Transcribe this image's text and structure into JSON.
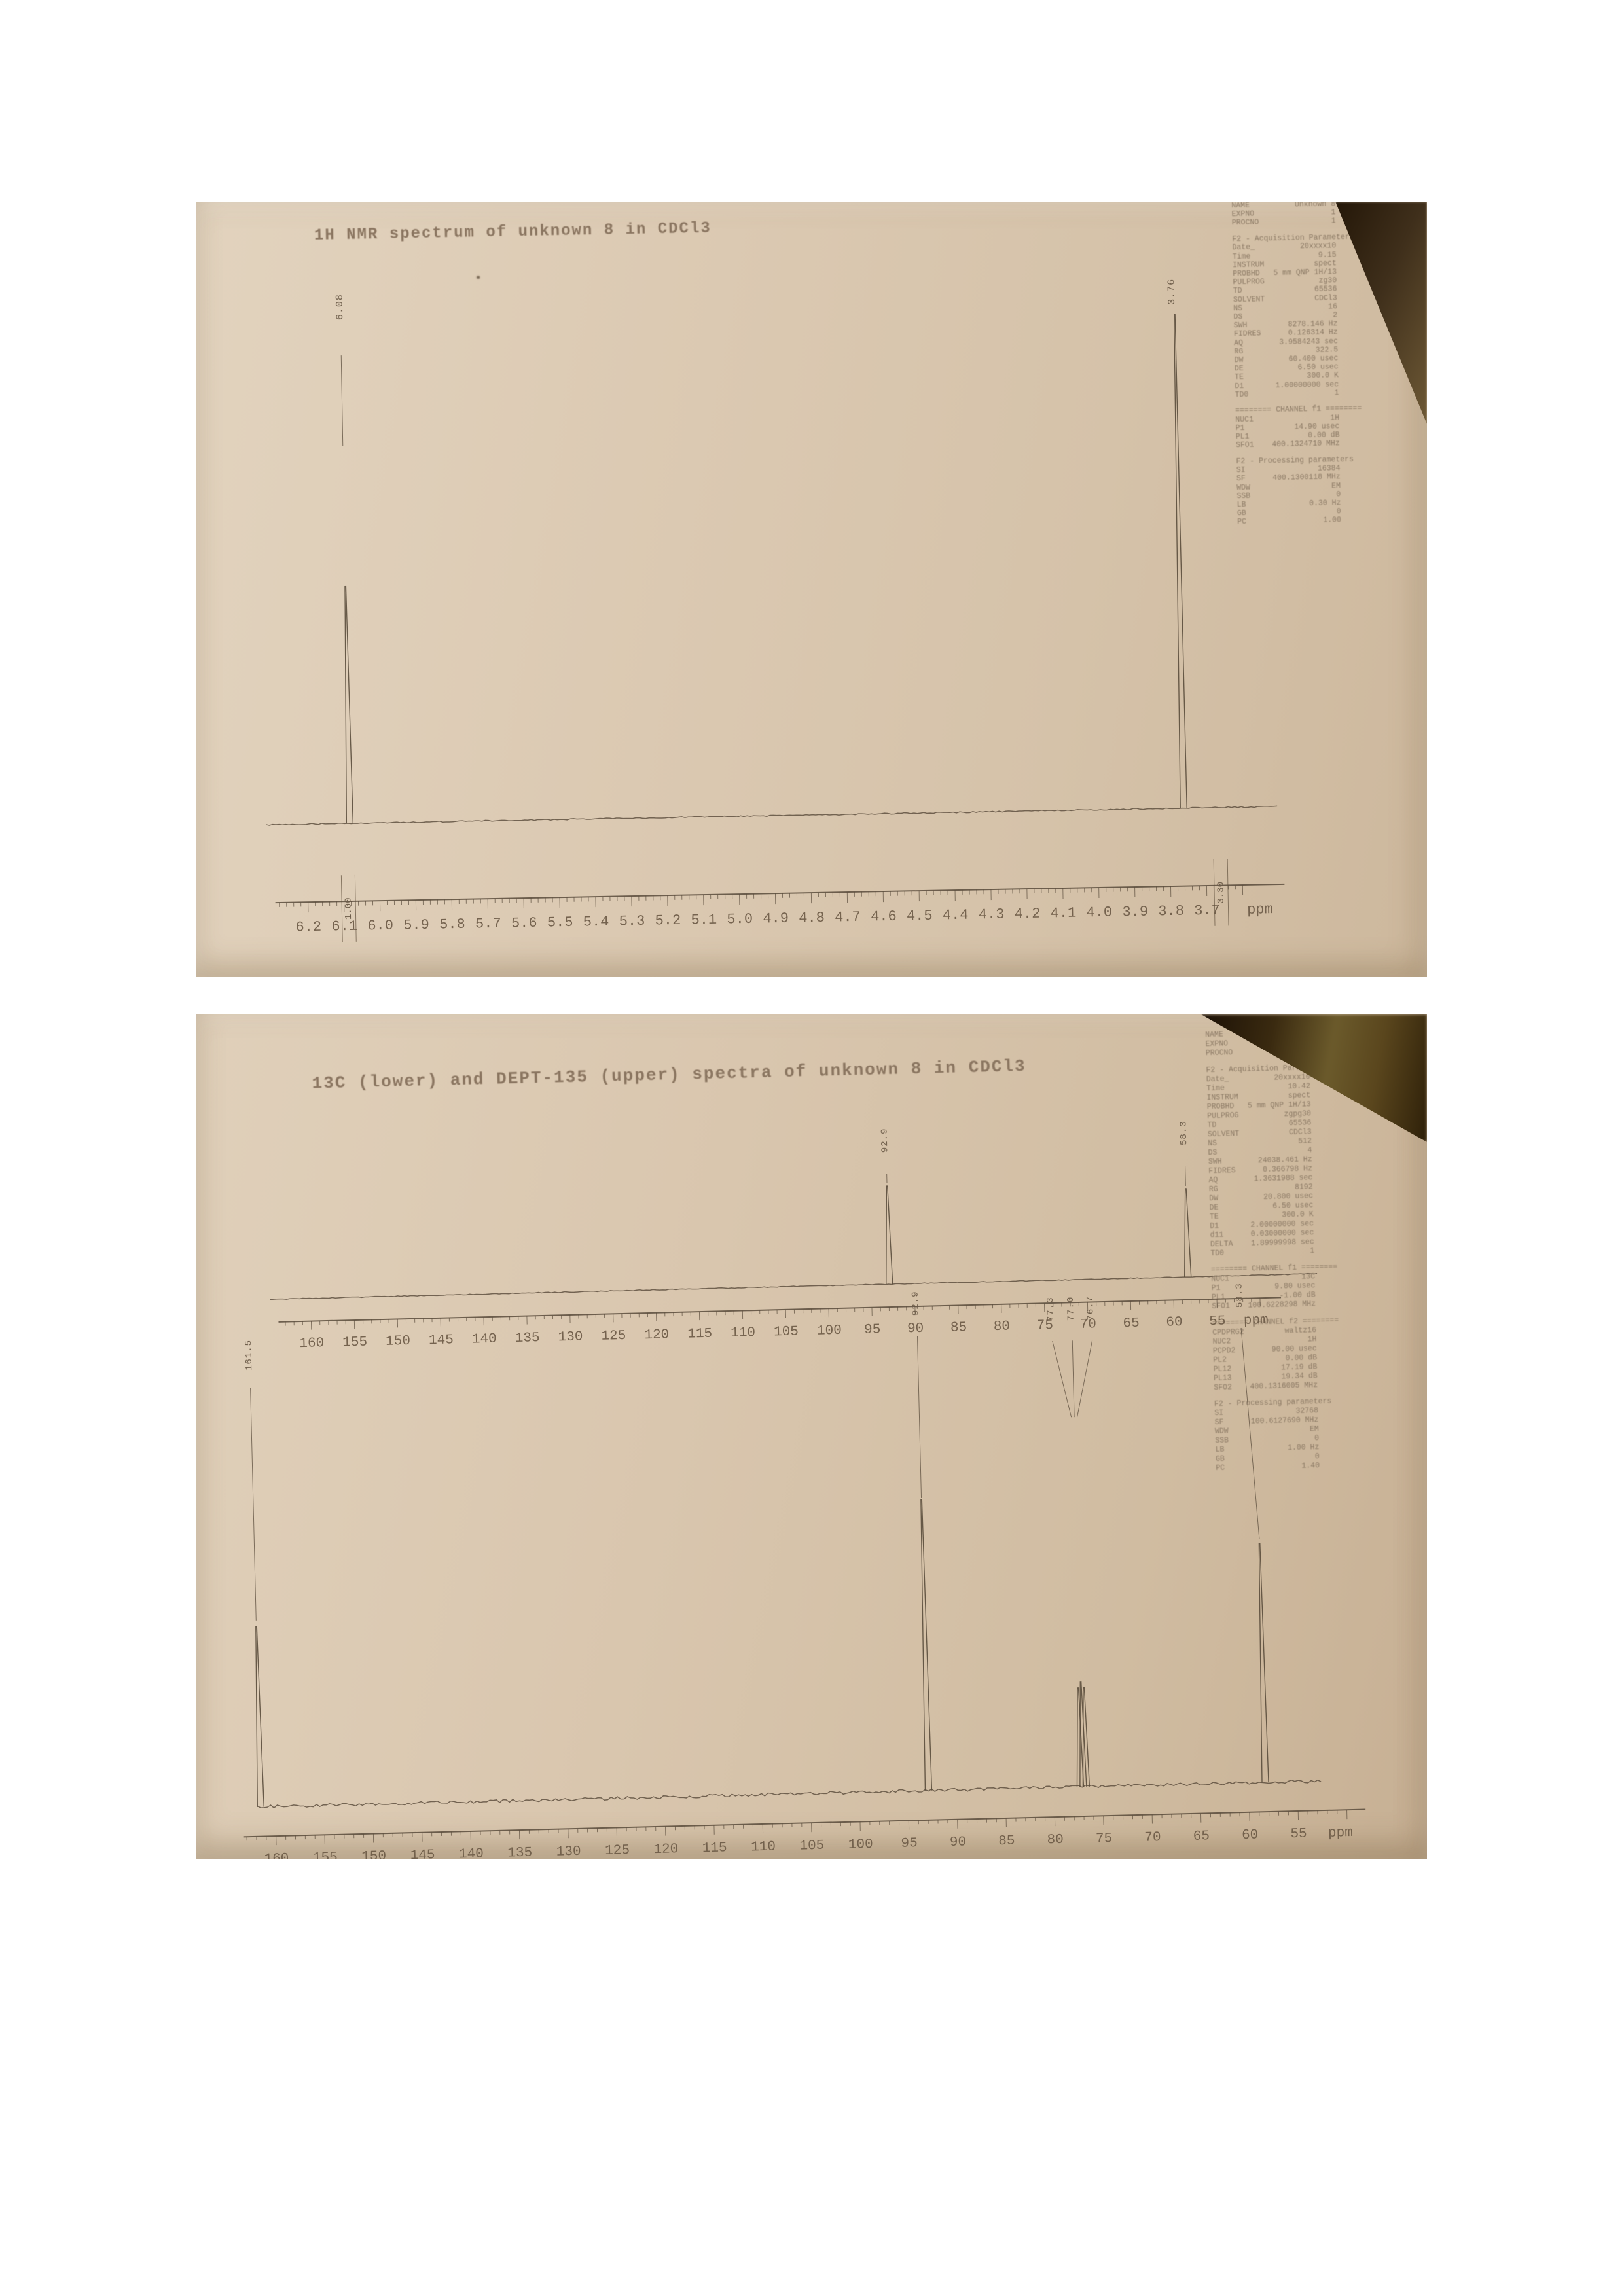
{
  "page": {
    "background": "#ffffff",
    "paper_color": "#d8c6af",
    "ink_color": "#5a4c3c"
  },
  "photo1": {
    "title": "1H NMR spectrum of unknown 8 in CDCl3",
    "params": [
      "NAME          Unknown 8",
      "EXPNO                 1",
      "PROCNO                1",
      "",
      "F2 - Acquisition Parameters",
      "Date_          20xxxx10",
      "Time               9.15",
      "INSTRUM           spect",
      "PROBHD   5 mm QNP 1H/13",
      "PULPROG            zg30",
      "TD                65536",
      "SOLVENT           CDCl3",
      "NS                   16",
      "DS                    2",
      "SWH         8278.146 Hz",
      "FIDRES      0.126314 Hz",
      "AQ        3.9584243 sec",
      "RG                322.5",
      "DW          60.400 usec",
      "DE            6.50 usec",
      "TE              300.0 K",
      "D1       1.00000000 sec",
      "TD0                   1",
      "",
      "======== CHANNEL f1 ========",
      "NUC1                 1H",
      "P1           14.90 usec",
      "PL1             0.00 dB",
      "SFO1    400.1324710 MHz",
      "",
      "F2 - Processing parameters",
      "SI                16384",
      "SF      400.1300118 MHz",
      "WDW                  EM",
      "SSB                   0",
      "LB              0.30 Hz",
      "GB                    0",
      "PC                 1.00"
    ]
  },
  "photo2": {
    "title": "13C (lower) and DEPT-135 (upper) spectra of unknown 8 in CDCl3",
    "params": [
      "NAME          Unknown 8",
      "EXPNO                 2",
      "PROCNO                1",
      "",
      "F2 - Acquisition Parameters",
      "Date_          20xxxx10",
      "Time              10.42",
      "INSTRUM           spect",
      "PROBHD   5 mm QNP 1H/13",
      "PULPROG          zgpg30",
      "TD                65536",
      "SOLVENT           CDCl3",
      "NS                  512",
      "DS                    4",
      "SWH        24038.461 Hz",
      "FIDRES      0.366798 Hz",
      "AQ        1.3631988 sec",
      "RG                 8192",
      "DW          20.800 usec",
      "DE            6.50 usec",
      "TE              300.0 K",
      "D1       2.00000000 sec",
      "d11      0.03000000 sec",
      "DELTA    1.89999998 sec",
      "TD0                   1",
      "",
      "======== CHANNEL f1 ========",
      "NUC1                13C",
      "P1            9.80 usec",
      "PL1            -1.00 dB",
      "SFO1    100.6228298 MHz",
      "",
      "======== CHANNEL f2 ========",
      "CPDPRG2         waltz16",
      "NUC2                 1H",
      "PCPD2        90.00 usec",
      "PL2             0.00 dB",
      "PL12           17.19 dB",
      "PL13           19.34 dB",
      "SFO2    400.1316005 MHz",
      "",
      "F2 - Processing parameters",
      "SI                32768",
      "SF      100.6127690 MHz",
      "WDW                  EM",
      "SSB                   0",
      "LB              1.00 Hz",
      "GB                    0",
      "PC                 1.40"
    ]
  },
  "chart_data": [
    {
      "type": "line",
      "subtype": "nmr-1h",
      "title": "1H NMR spectrum of unknown 8 in CDCl3",
      "xlabel": "ppm",
      "xlim": [
        6.25,
        3.65
      ],
      "x_reversed": true,
      "grid": false,
      "x_ticks": [
        "6.2",
        "6.1",
        "6.0",
        "5.9",
        "5.8",
        "5.7",
        "5.6",
        "5.5",
        "5.4",
        "5.3",
        "5.2",
        "5.1",
        "5.0",
        "4.9",
        "4.8",
        "4.7",
        "4.6",
        "4.5",
        "4.4",
        "4.3",
        "4.2",
        "4.1",
        "4.0",
        "3.9",
        "3.8",
        "3.7"
      ],
      "peaks": [
        {
          "ppm": 6.08,
          "label": "6.08",
          "integral": "1.00",
          "rel_intensity": 0.48
        },
        {
          "ppm": 3.76,
          "label": "3.76",
          "integral": "3.30",
          "rel_intensity": 1.0
        }
      ]
    },
    {
      "type": "line",
      "subtype": "dept-135",
      "title": "DEPT-135 (upper)",
      "xlabel": "ppm",
      "xlim": [
        162,
        53
      ],
      "x_reversed": true,
      "grid": false,
      "x_ticks": [
        "160",
        "155",
        "150",
        "145",
        "140",
        "135",
        "130",
        "125",
        "120",
        "115",
        "110",
        "105",
        "100",
        "95",
        "90",
        "85",
        "80",
        "75",
        "70",
        "65",
        "60",
        "55"
      ],
      "peaks": [
        {
          "ppm": 92.9,
          "label": "92.9",
          "phase": "up",
          "rel_intensity": 1.0
        },
        {
          "ppm": 58.3,
          "label": "58.3",
          "phase": "up",
          "rel_intensity": 0.9
        }
      ]
    },
    {
      "type": "line",
      "subtype": "nmr-13c",
      "title": "13C (lower)",
      "xlabel": "ppm",
      "xlim": [
        162,
        53
      ],
      "x_reversed": true,
      "grid": false,
      "x_ticks": [
        "160",
        "155",
        "150",
        "145",
        "140",
        "135",
        "130",
        "125",
        "120",
        "115",
        "110",
        "105",
        "100",
        "95",
        "90",
        "85",
        "80",
        "75",
        "70",
        "65",
        "60",
        "55"
      ],
      "peaks": [
        {
          "ppm": 161.5,
          "label": "161.5",
          "rel_intensity": 0.62
        },
        {
          "ppm": 92.9,
          "label": "92.9",
          "rel_intensity": 1.0
        },
        {
          "ppm": 77.3,
          "label": "77.3",
          "rel_intensity": 0.34,
          "assignment": "CDCl3"
        },
        {
          "ppm": 77.0,
          "label": "77.0",
          "rel_intensity": 0.36,
          "assignment": "CDCl3"
        },
        {
          "ppm": 76.7,
          "label": "76.7",
          "rel_intensity": 0.34,
          "assignment": "CDCl3"
        },
        {
          "ppm": 58.3,
          "label": "58.3",
          "rel_intensity": 0.82
        }
      ]
    }
  ]
}
